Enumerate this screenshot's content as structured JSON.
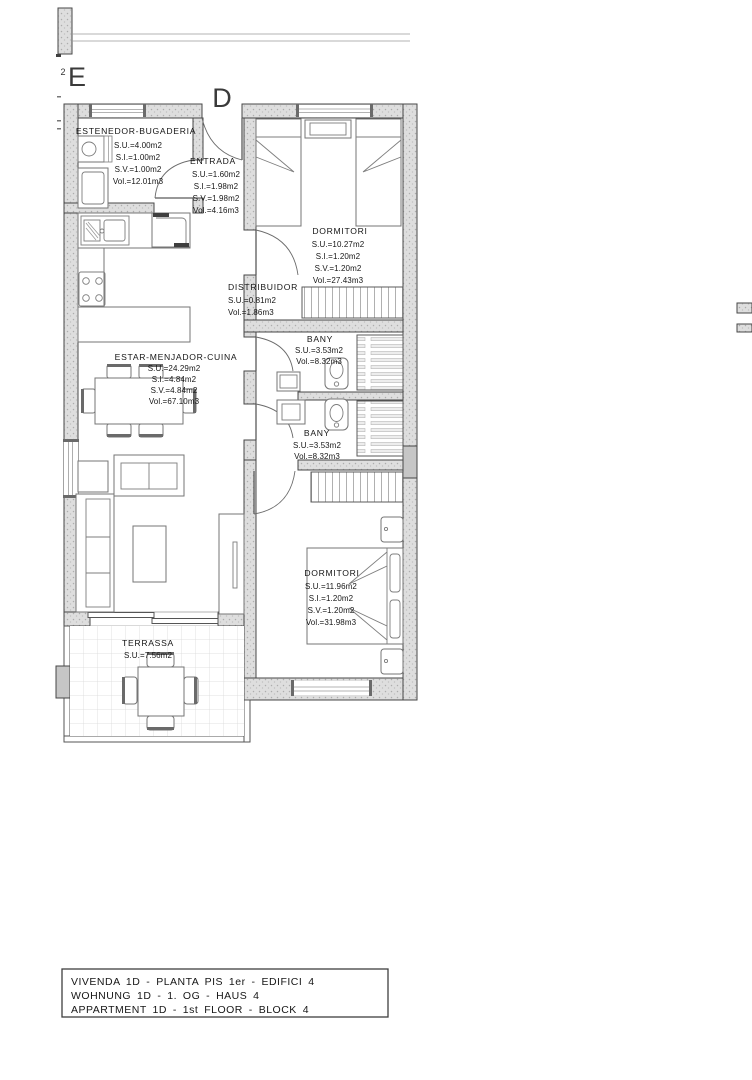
{
  "grid_marks": {
    "letter_e": "E",
    "letter_d": "D",
    "number_2": "2"
  },
  "rooms": {
    "estenedor": {
      "name": "ESTENEDOR-BUGADERIA",
      "su": "S.U.=4.00m2",
      "si": "S.I.=1.00m2",
      "sv": "S.V.=1.00m2",
      "vol": "Vol.=12.01m3"
    },
    "entrada": {
      "name": "ENTRADA",
      "su": "S.U.=1.60m2",
      "si": "S.I.=1.98m2",
      "sv": "S.V.=1.98m2",
      "vol": "Vol.=4.16m3"
    },
    "dormitori1": {
      "name": "DORMITORI",
      "su": "S.U.=10.27m2",
      "si": "S.I.=1.20m2",
      "sv": "S.V.=1.20m2",
      "vol": "Vol.=27.43m3"
    },
    "distribuidor": {
      "name": "DISTRIBUIDOR",
      "su": "S.U.=0.81m2",
      "vol": "Vol.=1.86m3"
    },
    "bany1": {
      "name": "BANY",
      "su": "S.U.=3.53m2",
      "vol": "Vol.=8.32m3"
    },
    "bany2": {
      "name": "BANY",
      "su": "S.U.=3.53m2",
      "vol": "Vol.=8.32m3"
    },
    "estar": {
      "name": "ESTAR-MENJADOR-CUINA",
      "su": "S.U.=24.29m2",
      "si": "S.I.=4.84m2",
      "sv": "S.V.=4.84m2",
      "vol": "Vol.=67.10m3"
    },
    "dormitori2": {
      "name": "DORMITORI",
      "su": "S.U.=11.96m2",
      "si": "S.I.=1.20m2",
      "sv": "S.V.=1.20m2",
      "vol": "Vol.=31.98m3"
    },
    "terrassa": {
      "name": "TERRASSA",
      "su": "S.U.=7.56m2"
    }
  },
  "title_block": {
    "line1": "VIVENDA 1D - PLANTA PIS 1er - EDIFICI 4",
    "line2": "WOHNUNG 1D - 1. OG - HAUS 4",
    "line3": "APPARTMENT 1D - 1st FLOOR - BLOCK 4"
  },
  "colors": {
    "wall_fill": "#dedede",
    "line_dark": "#474747",
    "line_light": "#9a9a9a",
    "text": "#161616",
    "background": "#ffffff"
  }
}
